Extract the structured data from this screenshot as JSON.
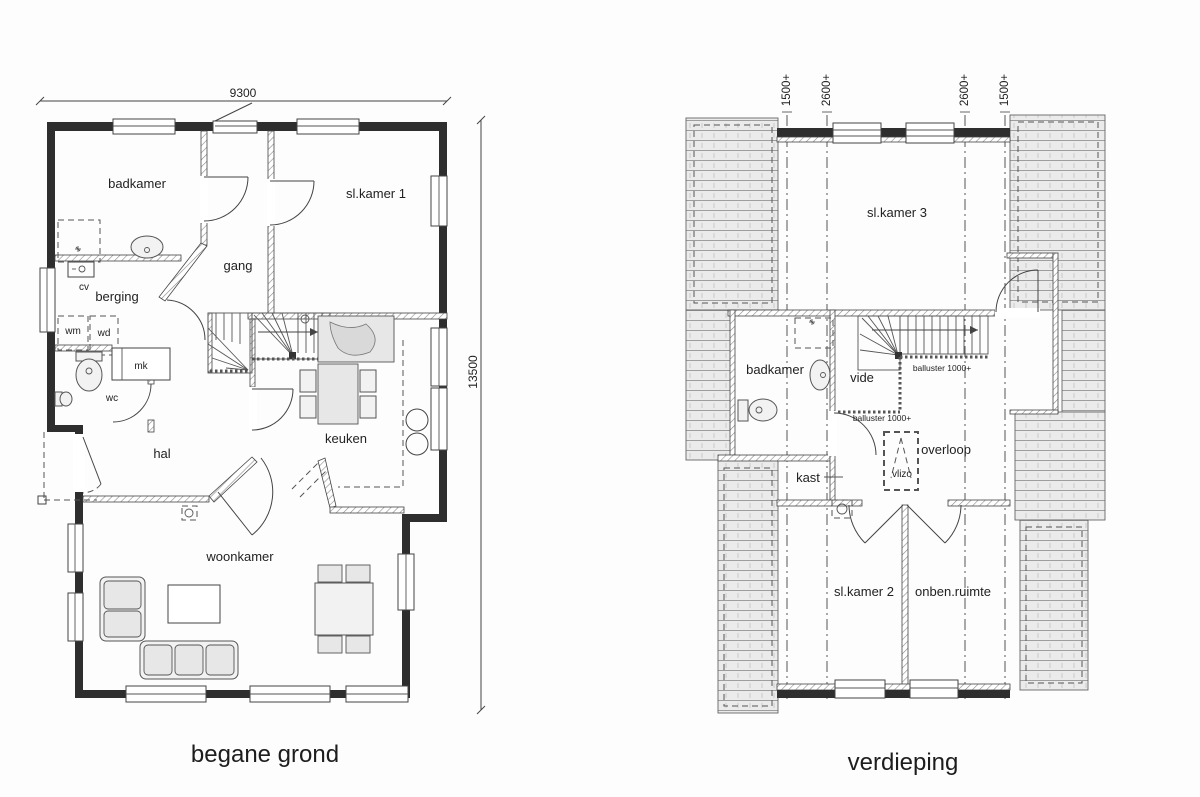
{
  "ground_floor": {
    "caption": "begane grond",
    "dim_width": "9300",
    "dim_height": "13500",
    "rooms": {
      "badkamer": "badkamer",
      "sl_kamer_1": "sl.kamer 1",
      "gang": "gang",
      "berging": "berging",
      "cv": "cv",
      "wm": "wm",
      "wd": "wd",
      "mk": "mk",
      "wc": "wc",
      "hal": "hal",
      "keuken": "keuken",
      "woonkamer": "woonkamer"
    }
  },
  "upper_floor": {
    "caption": "verdieping",
    "height_marks": [
      "1500+",
      "2600+",
      "2600+",
      "1500+"
    ],
    "balusters": [
      "balluster 1000+",
      "balluster 1000+"
    ],
    "rooms": {
      "sl_kamer_3": "sl.kamer 3",
      "badkamer": "badkamer",
      "vide": "vide",
      "overloop": "overloop",
      "vlizo": "vlizo",
      "kast": "kast",
      "sl_kamer_2": "sl.kamer 2",
      "onben_ruimte": "onben.ruimte"
    }
  }
}
